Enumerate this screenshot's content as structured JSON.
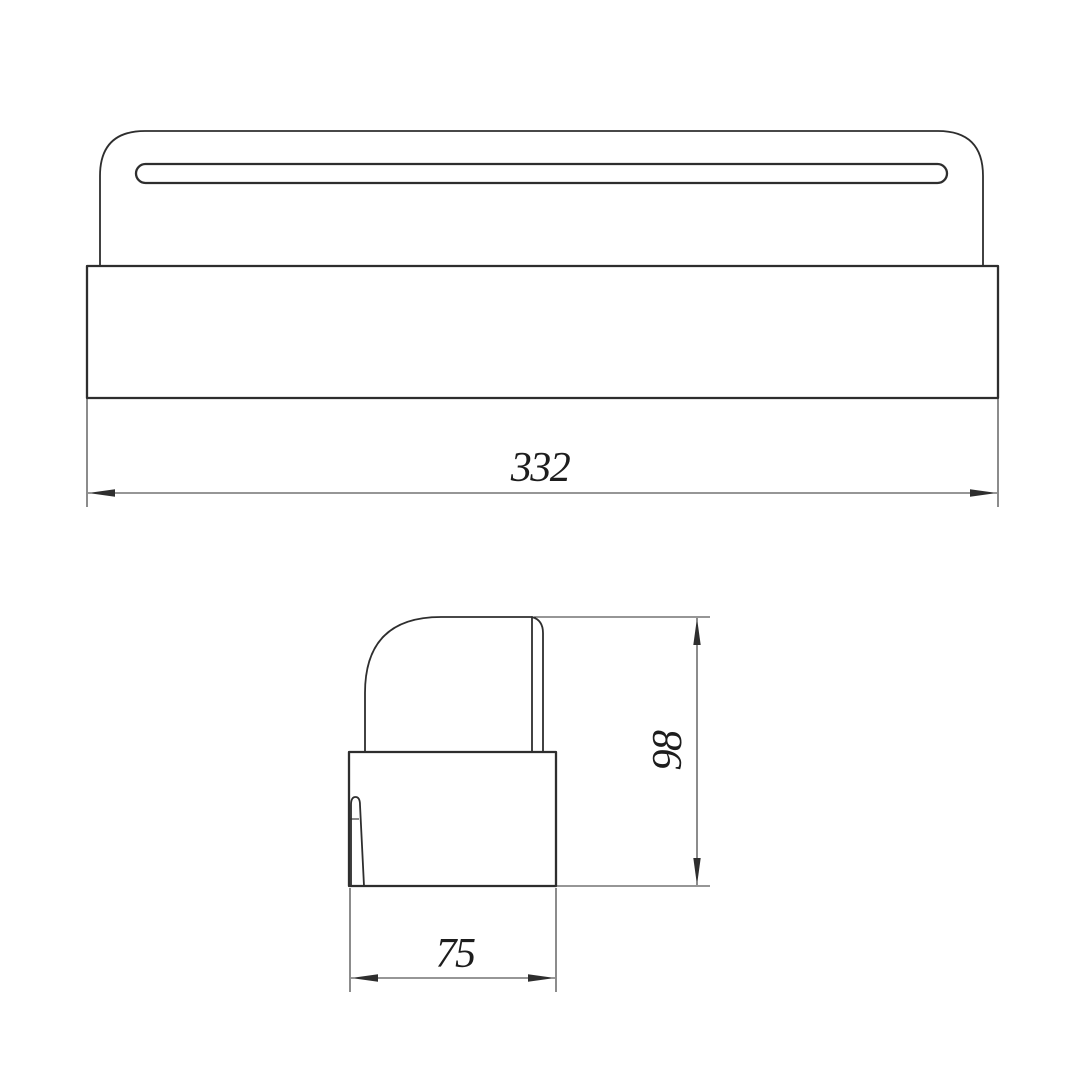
{
  "drawing": {
    "background_color": "#ffffff",
    "line_color": "#2e2e2e",
    "text_color": "#1d1d1d",
    "views": {
      "top_view": {
        "id": "top-view"
      },
      "side_view": {
        "id": "side-view"
      }
    },
    "dimensions": {
      "length": {
        "value": "332"
      },
      "height": {
        "value": "98"
      },
      "depth": {
        "value": "75"
      }
    }
  }
}
